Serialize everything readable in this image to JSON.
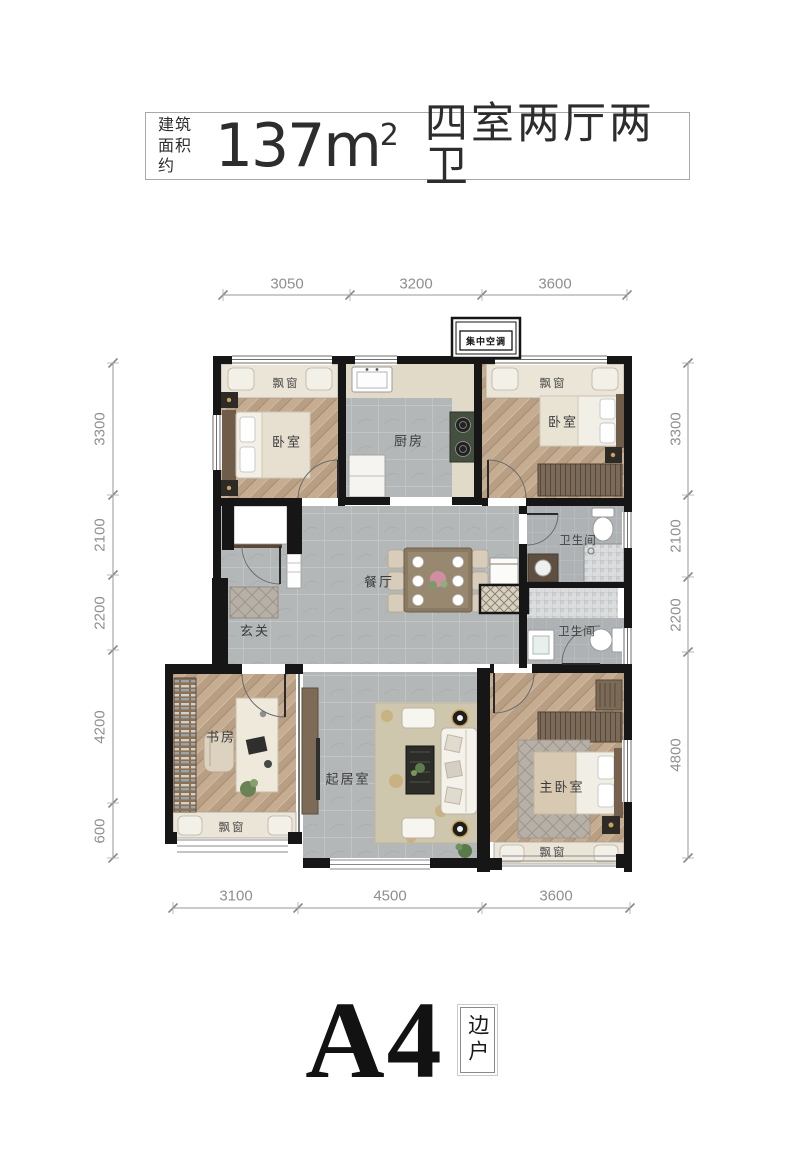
{
  "header": {
    "area_prefix_line1": "建筑",
    "area_prefix_line2": "面积约",
    "area_number": "137m",
    "area_sup": "2",
    "layout_text": "四室两厅两卫"
  },
  "plan": {
    "hvac_label": "集中空调",
    "bay_window_label": "飘窗",
    "rooms": {
      "bedroom_top_left": "卧室",
      "kitchen": "厨房",
      "bedroom_top_right": "卧室",
      "bathroom_upper": "卫生间",
      "bathroom_lower": "卫生间",
      "dining": "餐厅",
      "foyer": "玄关",
      "study": "书房",
      "living": "起居室",
      "master_bedroom": "主卧室"
    },
    "dimensions": {
      "top": [
        "3050",
        "3200",
        "3600"
      ],
      "bottom": [
        "3100",
        "4500",
        "3600"
      ],
      "left": [
        "3300",
        "2100",
        "2200",
        "4200",
        "600"
      ],
      "right": [
        "3300",
        "2100",
        "2200",
        "4800"
      ]
    }
  },
  "footer": {
    "unit_name": "A4",
    "unit_tag": "边户"
  },
  "colors": {
    "wall": "#161616",
    "wood_floor": "#c6ac90",
    "tile_floor": "#b4b7b8",
    "bay_window": "#ebe5d8",
    "dimension_text": "#8f8f8f"
  }
}
